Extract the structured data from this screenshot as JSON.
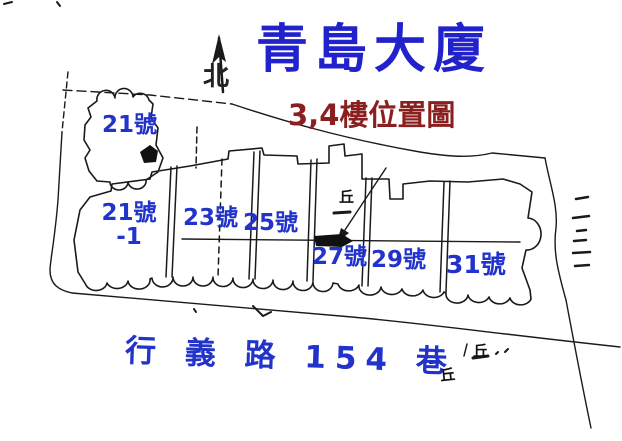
{
  "header": {
    "title": "青島大廈",
    "subtitle": "3,4樓位置圖",
    "north_label": "北"
  },
  "map": {
    "street_label": "行 義 路 154 巷",
    "buildings": [
      {
        "label": "21號"
      },
      {
        "label": "21號",
        "sublabel": "-1"
      },
      {
        "label": "23號"
      },
      {
        "label": "25號"
      },
      {
        "label": "27號"
      },
      {
        "label": "29號"
      },
      {
        "label": "31號"
      }
    ],
    "marker_glyph": "丘"
  },
  "colors": {
    "title_blue": "#2222cc",
    "subtitle_red": "#8b1e1e",
    "label_blue": "#2233cc",
    "line_black": "#1a1a1a",
    "background": "#ffffff"
  }
}
